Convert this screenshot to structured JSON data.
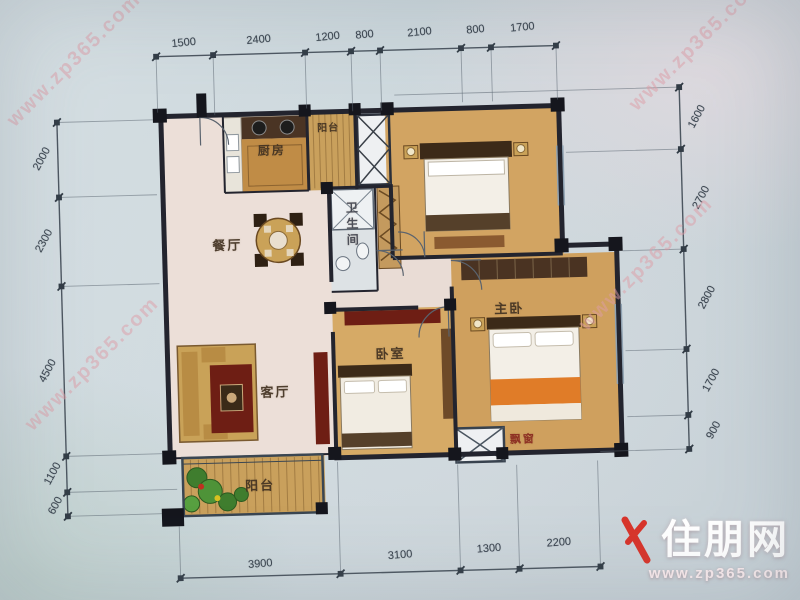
{
  "watermark": {
    "diagonal_text": "www.zp365.com",
    "logo_text": "住朋网",
    "logo_url": "www.zp365.com"
  },
  "dimensions": {
    "top": [
      "1500",
      "2400",
      "1200",
      "800",
      "2100",
      "800",
      "1700"
    ],
    "left": [
      "2000",
      "2300",
      "4500",
      "1100",
      "600"
    ],
    "right": [
      "1600",
      "2700",
      "2800",
      "1700",
      "900"
    ],
    "bottom": [
      "3900",
      "3100",
      "1300",
      "2200"
    ]
  },
  "rooms": {
    "dining": "餐厅",
    "kitchen": "厨房",
    "balcony_top": "阳台",
    "bathroom": "卫生间",
    "bedroom": "卧室",
    "master": "主卧",
    "living": "客厅",
    "balcony_bottom": "阳台",
    "bay_window": "飘窗"
  },
  "colors": {
    "background": "#cdd7dc",
    "floor_pink": "#ecdfd8",
    "wood": "#cfa05e",
    "wall": "#23242e",
    "accent_red": "#d8342a",
    "watermark_pink": "#e0a0aa"
  }
}
